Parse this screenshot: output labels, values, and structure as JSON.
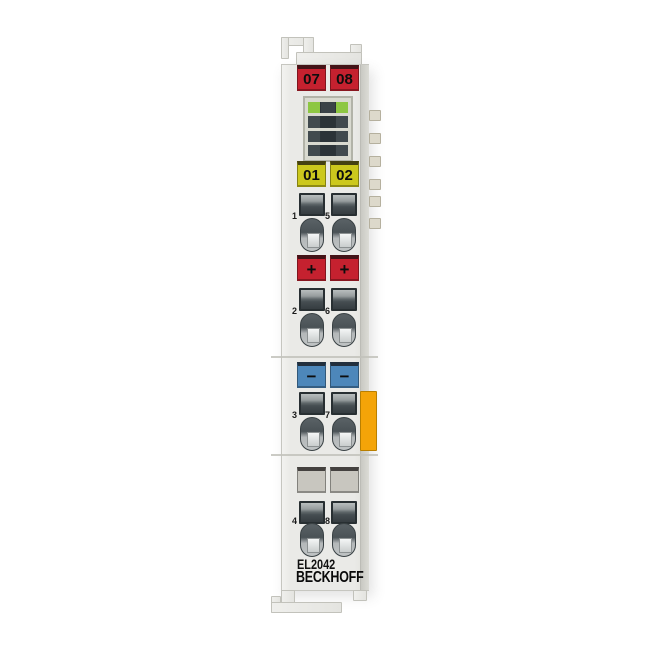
{
  "product": {
    "model": "EL2042",
    "brand": "BECKHOFF"
  },
  "labels": {
    "top": [
      {
        "text": "07",
        "bg": "#c5212f"
      },
      {
        "text": "08",
        "bg": "#c5212f"
      }
    ],
    "signal": [
      {
        "text": "01",
        "bg": "#ccc81d"
      },
      {
        "text": "02",
        "bg": "#ccc81d"
      }
    ],
    "plus": [
      {
        "text": "+",
        "bg": "#c5212f"
      },
      {
        "text": "+",
        "bg": "#c5212f"
      }
    ],
    "minus": [
      {
        "text": "−",
        "bg": "#4d87ba"
      },
      {
        "text": "−",
        "bg": "#4d87ba"
      }
    ],
    "blank": [
      {
        "text": "",
        "bg": "#c8c6bf"
      },
      {
        "text": "",
        "bg": "#c8c6bf"
      }
    ]
  },
  "terminal_numbers": [
    "1",
    "5",
    "2",
    "6",
    "3",
    "7",
    "4",
    "8"
  ],
  "led": {
    "rows": [
      [
        "#8dc742",
        "#3a4347",
        "#8dc742"
      ],
      [
        "#414a4e",
        "#2b3337",
        "#414a4e"
      ],
      [
        "#414a4e",
        "#2b3337",
        "#414a4e"
      ],
      [
        "#414a4e",
        "#2b3337",
        "#414a4e"
      ]
    ]
  },
  "colors": {
    "label_red": "#c5212f",
    "label_yellow": "#ccc81d",
    "label_blue": "#4d87ba",
    "led_green": "#8dc742",
    "accent_orange": "#f4a408",
    "housing_gray": "#eaeae7",
    "clamp_dark": "#363d41"
  }
}
